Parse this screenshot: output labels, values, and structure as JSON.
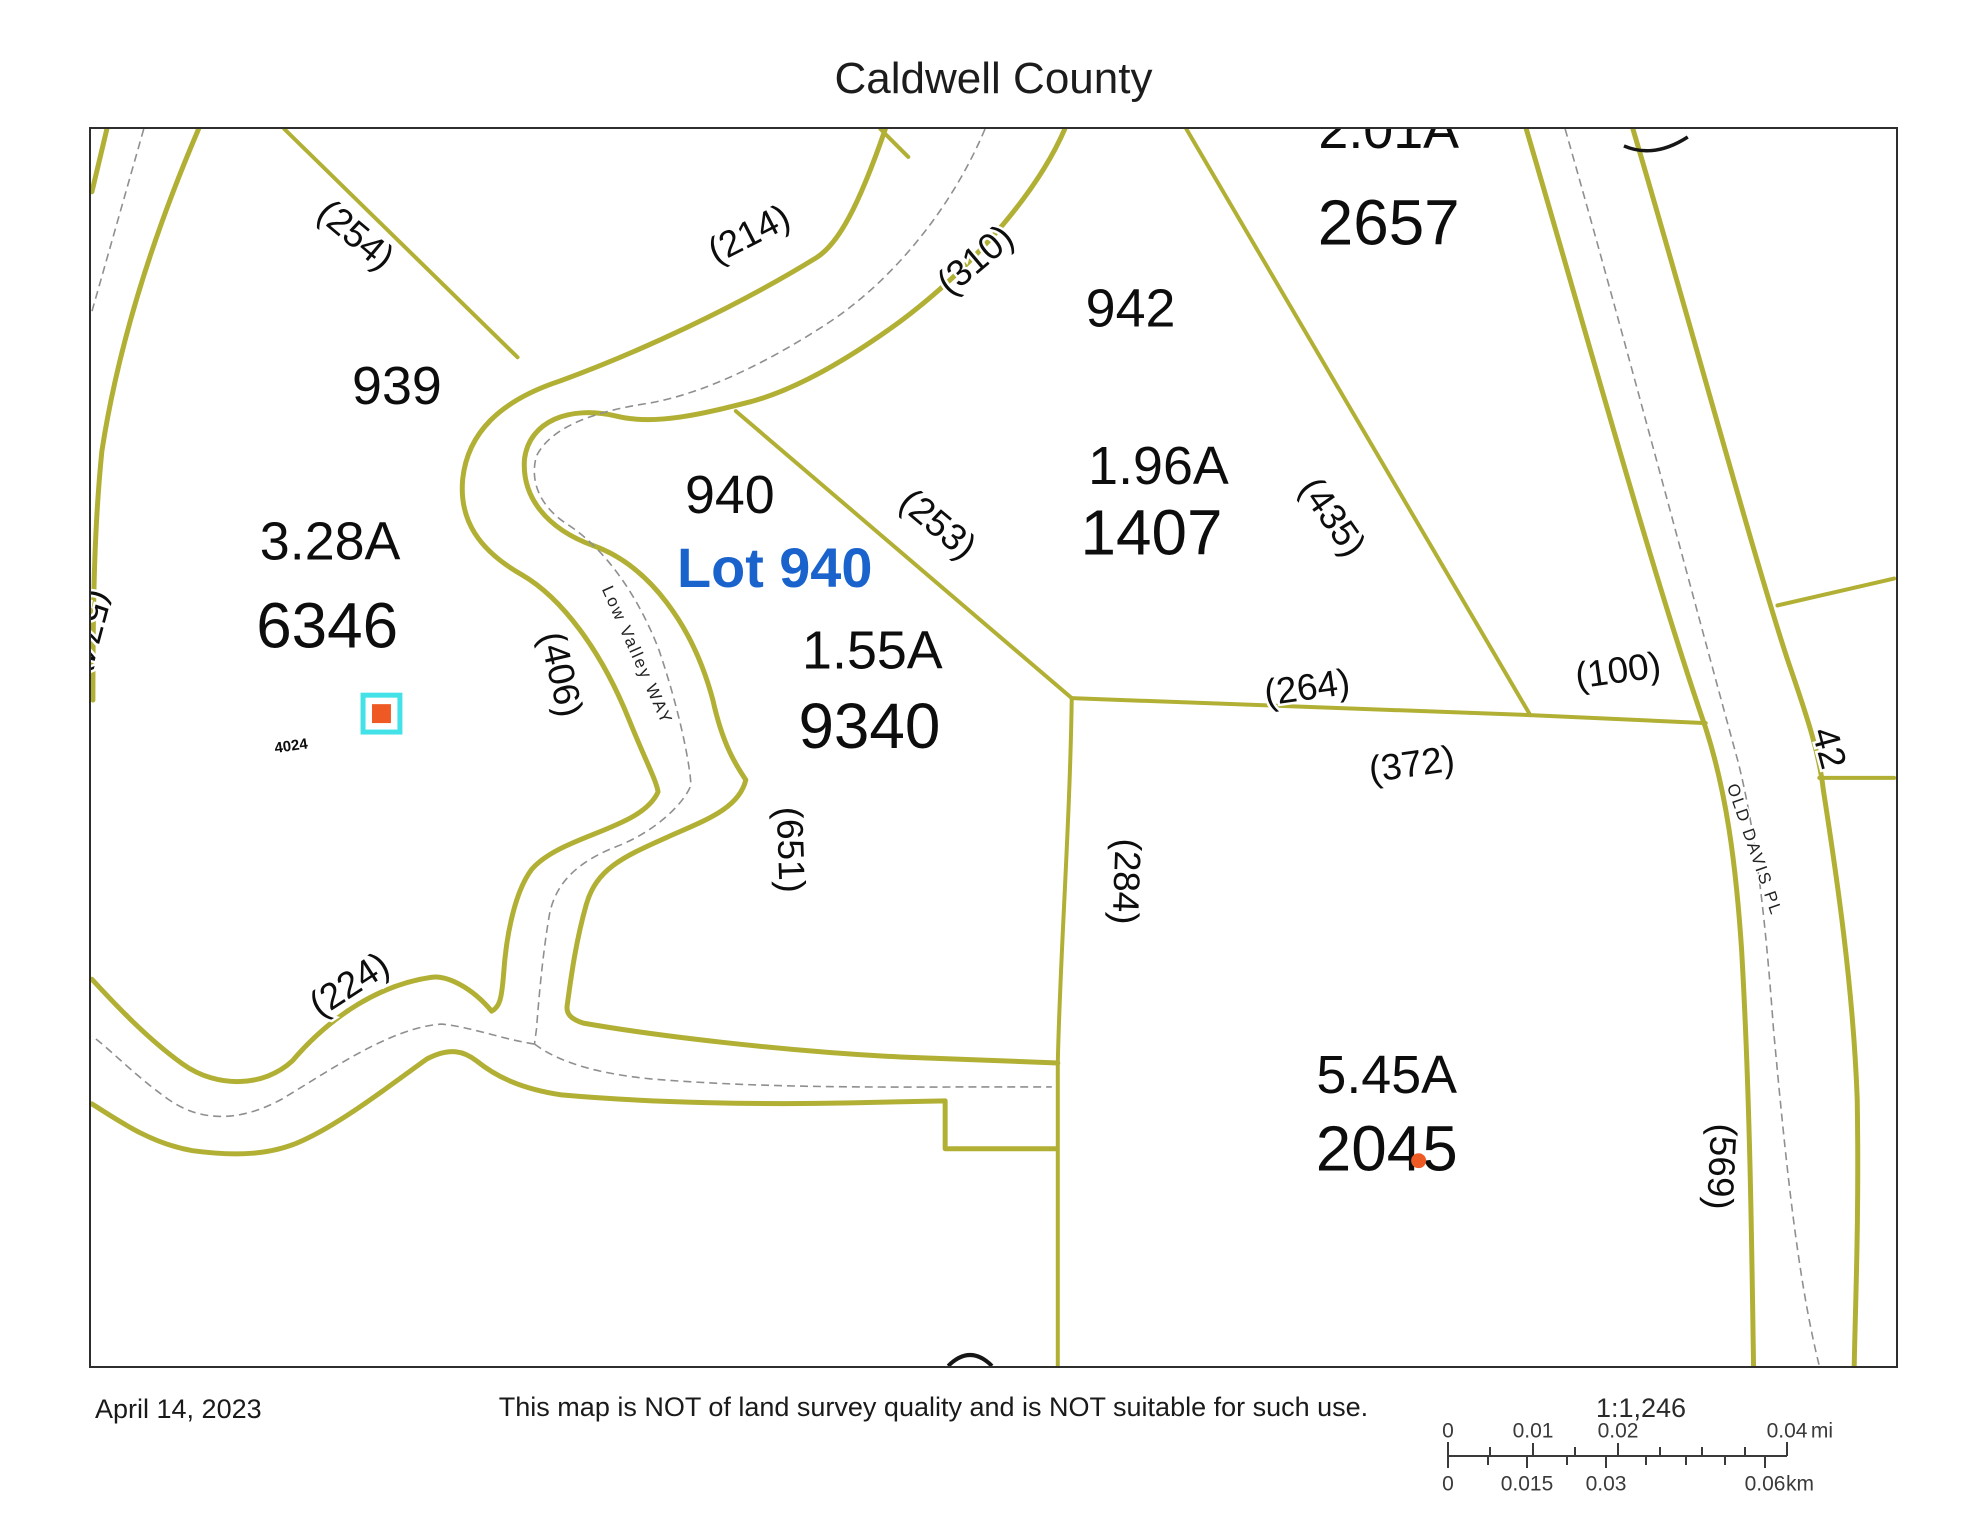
{
  "title": "Caldwell County",
  "map": {
    "colors": {
      "accent_blue": "#1a63cc",
      "line_olive": "#b1b035",
      "centerline_gray": "#8f8f8f",
      "marker_orange": "#ef5a24",
      "marker_cyan": "#42e2e8"
    },
    "roads": {
      "low_valley": "Low Valley WAY",
      "old_davis": "OLD DAVIS PL"
    },
    "parcels": {
      "p939": {
        "lot": "939",
        "acreage": "3.28A",
        "id": "6346"
      },
      "p940": {
        "lot": "940",
        "selected_label": "Lot 940",
        "acreage": "1.55A",
        "id": "9340"
      },
      "p942": {
        "lot": "942",
        "acreage": "1.96A",
        "id": "1407"
      },
      "p2657": {
        "acreage": "2.01A",
        "id": "2657"
      },
      "p2045": {
        "acreage": "5.45A",
        "id": "2045"
      },
      "p42": {
        "id": "42"
      }
    },
    "segment_labels": {
      "t254": "(254)",
      "t214": "(214)",
      "t310": "(310)",
      "t253": "(253)",
      "t435": "(435)",
      "t406": "(406)",
      "t651": "(651)",
      "t264": "(264)",
      "t100": "(100)",
      "t372": "(372)",
      "t284": "(284)",
      "t224": "(224)",
      "t569": "(569)",
      "t574": "(574)"
    },
    "marker": {
      "label": "4024"
    }
  },
  "footer": {
    "date": "April 14, 2023",
    "disclaimer": "This map is NOT of land survey quality and is NOT suitable for such use."
  },
  "scalebar": {
    "ratio": "1:1,246",
    "mi_labels": [
      "0",
      "0.01",
      "0.02",
      "0.04"
    ],
    "mi_unit": "mi",
    "km_labels": [
      "0",
      "0.015",
      "0.03",
      "0.06"
    ],
    "km_unit": "km"
  }
}
